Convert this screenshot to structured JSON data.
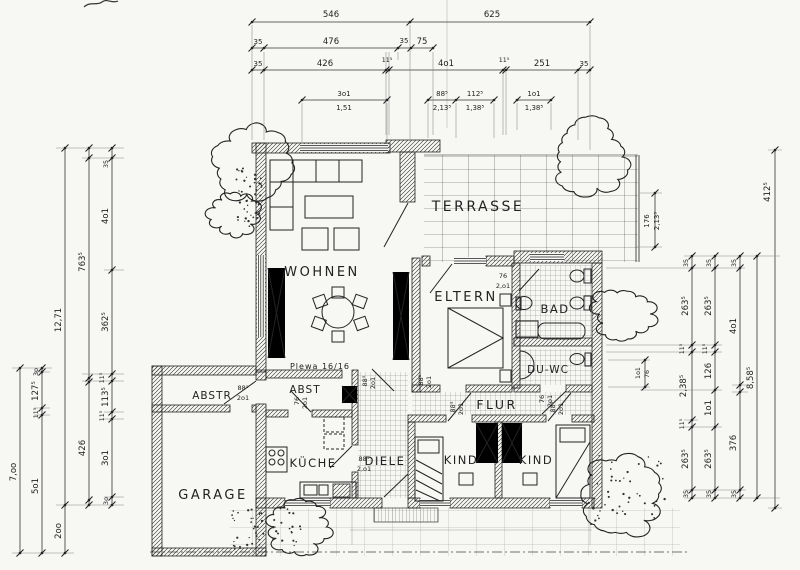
{
  "rooms": {
    "wohnen": "WOHNEN",
    "terrasse": "TERRASSE",
    "eltern": "ELTERN",
    "bad": "BAD",
    "du_wc": "DU-WC",
    "flur": "FLUR",
    "diele": "DIELE",
    "kind_links": "KIND",
    "kind_rechts": "KIND",
    "kueche": "KÜCHE",
    "garage": "GARAGE",
    "abstellraum": "ABSTR",
    "abstell": "ABST"
  },
  "chimney_label": "Plewa 16/16",
  "dims": {
    "top1": [
      "546",
      "625"
    ],
    "top2": [
      "35",
      "476",
      "35",
      "75"
    ],
    "top3": [
      "35",
      "426",
      "11⁵",
      "4o1",
      "11⁵",
      "251",
      "35"
    ],
    "top4u": [
      "3o1",
      "88⁵",
      "112⁵",
      "1o1"
    ],
    "top4l": [
      "1,51",
      "2,13⁵",
      "1,38⁵",
      "1,38⁵"
    ],
    "left_col1": [
      "12,71"
    ],
    "left_col2": [
      "763⁵",
      "426"
    ],
    "left_col3": [
      "35",
      "4o1",
      "362⁵",
      "11⁵",
      "113⁵",
      "11⁵",
      "3o1",
      "3o"
    ],
    "left_col4": [
      "7,oo"
    ],
    "left_col5": [
      "3o",
      "127⁵",
      "11⁵",
      "5o1"
    ],
    "left_col6": [
      "2oo"
    ],
    "right_col1": [
      "35",
      "263⁵",
      "11⁵",
      "2,38⁵",
      "11⁵",
      "263⁵",
      "35"
    ],
    "right_col2": [
      "35",
      "263⁵",
      "11⁵",
      "126",
      "1o1",
      "263⁵",
      "35"
    ],
    "right_col3": [
      "35",
      "4o1",
      "376",
      "35"
    ],
    "right_col4": [
      "8,58⁵"
    ],
    "right_col5": [
      "412⁵"
    ],
    "terrace_depth": [
      "176",
      "2,13⁵"
    ],
    "duwc_window": [
      "1o1",
      "76"
    ]
  },
  "door_dims": [
    {
      "a": "88⁵",
      "b": "2o1"
    },
    {
      "a": "76",
      "b": "2o1"
    },
    {
      "a": "88⁵",
      "b": "2o1"
    },
    {
      "a": "88⁵",
      "b": "2o1"
    },
    {
      "a": "88⁵",
      "b": "2,o1"
    },
    {
      "a": "88⁵",
      "b": "2o1"
    },
    {
      "a": "88⁵",
      "b": "2o1"
    },
    {
      "a": "76",
      "b": "2o1"
    },
    {
      "a": "76",
      "b": "2,o1"
    }
  ],
  "colors": {
    "ink": "#232323",
    "paper": "#f7f7f4"
  }
}
